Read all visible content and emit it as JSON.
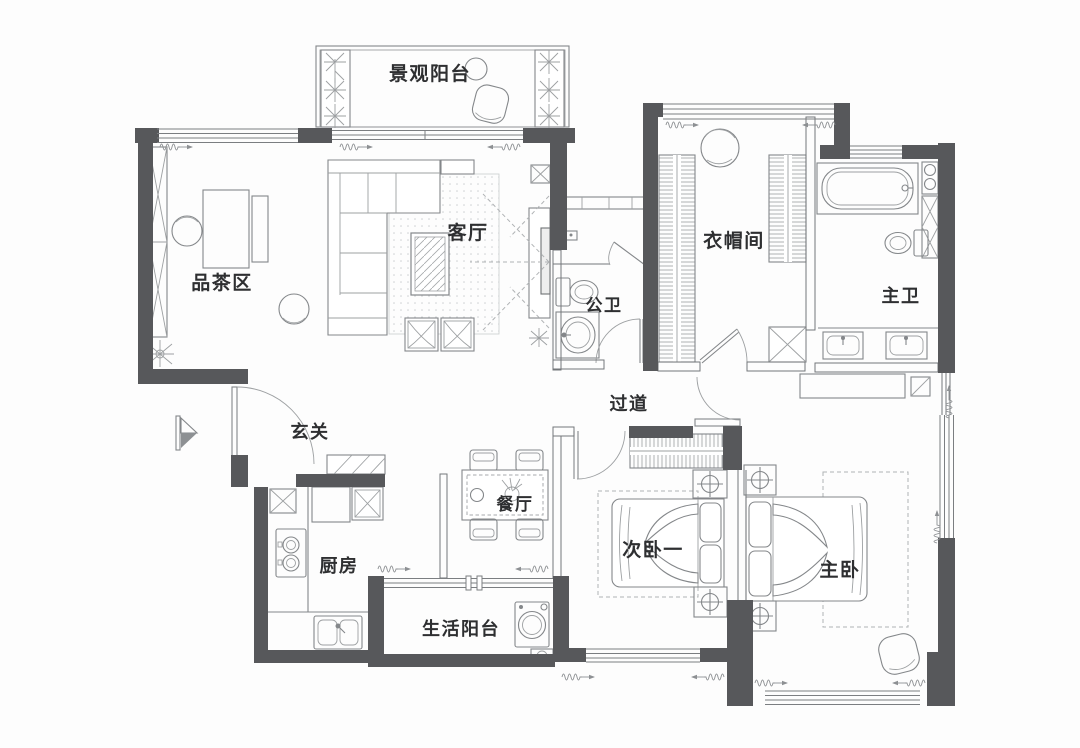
{
  "meta": {
    "type": "apartment-floor-plan",
    "language": "zh-CN"
  },
  "rooms": {
    "viewing_balcony": "景观阳台",
    "living_room": "客厅",
    "tea_area": "品茶区",
    "guest_bath": "公卫",
    "cloakroom": "衣帽间",
    "master_bath": "主卫",
    "hallway": "过道",
    "foyer": "玄关",
    "dining": "餐厅",
    "kitchen": "厨房",
    "utility_balcony": "生活阳台",
    "second_bedroom": "次卧一",
    "master_bedroom": "主卧"
  },
  "colors": {
    "wall": "#57585b",
    "furniture_line": "#84878a",
    "dashed_line": "#b0b3b5",
    "text": "#2e2f31",
    "background": "#fdfdfd"
  }
}
